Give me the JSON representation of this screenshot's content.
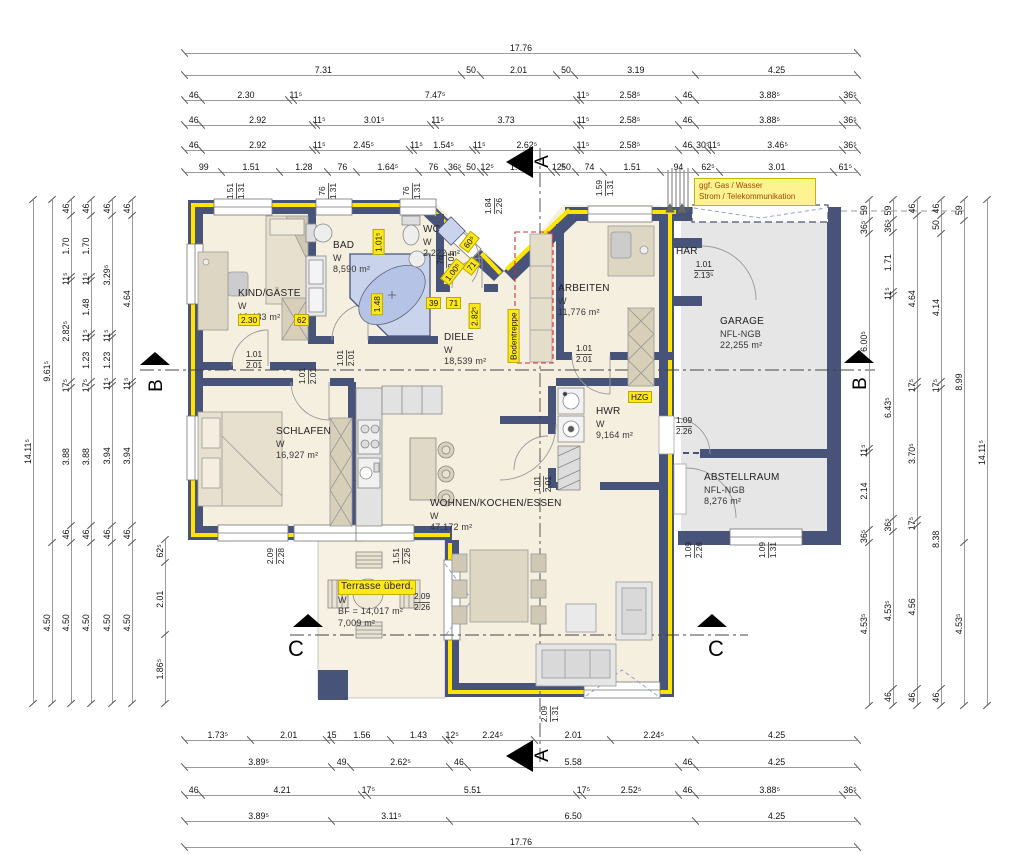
{
  "note": {
    "line1": "ggf. Gas / Wasser",
    "line2": "Strom / Telekommunikation"
  },
  "colors": {
    "wall": "#475379",
    "insulation_yellow": "#ffe400",
    "floor_cream": "#f5efe0",
    "garage_gray": "#e6e6e6",
    "highlight_yellow": "#ffe81a",
    "tub_blue": "#c9d4ec",
    "red_dashed": "#d03030",
    "dim_line_gray": "#9a9a9a"
  },
  "rooms": [
    {
      "id": "kind",
      "x": 238,
      "y": 288,
      "lines": [
        "KIND/GÄSTE",
        "W",
        "12,483 m²"
      ]
    },
    {
      "id": "bad",
      "x": 333,
      "y": 240,
      "lines": [
        "BAD",
        "W",
        "8,590 m²"
      ]
    },
    {
      "id": "wc",
      "x": 423,
      "y": 224,
      "lines": [
        "WC",
        "W",
        "2,222 m²"
      ]
    },
    {
      "id": "arbeiten",
      "x": 558,
      "y": 283,
      "lines": [
        "ARBEITEN",
        "W",
        "11,776 m²"
      ]
    },
    {
      "id": "garage",
      "x": 720,
      "y": 316,
      "lines": [
        "GARAGE",
        "NFL-NGB",
        "22,255 m²"
      ]
    },
    {
      "id": "har",
      "x": 676,
      "y": 246,
      "lines": [
        "HAR"
      ]
    },
    {
      "id": "diele",
      "x": 444,
      "y": 332,
      "lines": [
        "DIELE",
        "W",
        "18,539 m²"
      ]
    },
    {
      "id": "schlafen",
      "x": 276,
      "y": 426,
      "lines": [
        "SCHLAFEN",
        "W",
        "16,927 m²"
      ]
    },
    {
      "id": "wohnen",
      "x": 430,
      "y": 498,
      "lines": [
        "WOHNEN/KOCHEN/ESSEN",
        "W",
        "47,172 m²"
      ]
    },
    {
      "id": "hwr",
      "x": 596,
      "y": 406,
      "lines": [
        "HWR",
        "W",
        "9,164 m²"
      ]
    },
    {
      "id": "abstell",
      "x": 704,
      "y": 472,
      "lines": [
        "ABSTELLRAUM",
        "NFL-NGB",
        "8,276 m²"
      ]
    },
    {
      "id": "terrasse",
      "x": 338,
      "y": 580,
      "highlight_first": true,
      "lines": [
        "Terrasse überd.",
        "W",
        "BF = 14,017 m²",
        "7,009 m²"
      ]
    }
  ],
  "size_tags": [
    {
      "top": "1.01",
      "bot": "2.01",
      "x": 246,
      "y": 350,
      "vertical": false
    },
    {
      "top": "1.01",
      "bot": "2.01",
      "x": 338,
      "y": 348,
      "vertical": true
    },
    {
      "top": "1.01",
      "bot": "2.01",
      "x": 300,
      "y": 366,
      "vertical": true
    },
    {
      "top": "1.01",
      "bot": "2.01",
      "x": 535,
      "y": 474,
      "vertical": true
    },
    {
      "top": "1.01",
      "bot": "2.01",
      "x": 576,
      "y": 344,
      "vertical": false
    },
    {
      "top": "1.09",
      "bot": "2.26",
      "x": 676,
      "y": 416,
      "vertical": false
    },
    {
      "top": "1.01",
      "bot": "2.13⁵",
      "x": 694,
      "y": 260,
      "vertical": false
    },
    {
      "top": "1.09",
      "bot": "2.26",
      "x": 686,
      "y": 540,
      "vertical": true
    },
    {
      "top": "1.09",
      "bot": "1.31",
      "x": 760,
      "y": 540,
      "vertical": true
    },
    {
      "top": "2.09",
      "bot": "2.26",
      "x": 414,
      "y": 592,
      "vertical": false
    },
    {
      "top": "2.09",
      "bot": "2.28",
      "x": 268,
      "y": 546,
      "vertical": true
    },
    {
      "top": "1.51",
      "bot": "2.26",
      "x": 394,
      "y": 546,
      "vertical": true
    },
    {
      "top": "2.09",
      "bot": "1.31",
      "x": 542,
      "y": 704,
      "vertical": true
    },
    {
      "top": "1.84",
      "bot": "2.26",
      "x": 486,
      "y": 196,
      "vertical": true
    },
    {
      "top": "1.59",
      "bot": "1.31",
      "x": 597,
      "y": 178,
      "vertical": true
    },
    {
      "top": "3.01",
      "bot": "2.26",
      "x": 738,
      "y": 188,
      "vertical": true
    },
    {
      "top": "1.51",
      "bot": "1.31",
      "x": 228,
      "y": 181,
      "vertical": true
    },
    {
      "top": "76",
      "bot": "1.31",
      "x": 320,
      "y": 181,
      "vertical": true
    },
    {
      "top": "76",
      "bot": "1.31",
      "x": 404,
      "y": 181,
      "vertical": true
    },
    {
      "top": "76",
      "bot": "2.01",
      "x": 438,
      "y": 250,
      "vertical": true
    }
  ],
  "yellow_labels": [
    {
      "text": "2.30",
      "x": 238,
      "y": 314,
      "rot": 0
    },
    {
      "text": "62",
      "x": 294,
      "y": 314,
      "rot": 0
    },
    {
      "text": "1.01⁵",
      "x": 366,
      "y": 236,
      "rot": -90
    },
    {
      "text": "1.48",
      "x": 366,
      "y": 298,
      "rot": -90
    },
    {
      "text": "39",
      "x": 426,
      "y": 297,
      "rot": 0
    },
    {
      "text": "71",
      "x": 446,
      "y": 297,
      "rot": 0
    },
    {
      "text": "60⁵",
      "x": 460,
      "y": 236,
      "rot": -52
    },
    {
      "text": "71",
      "x": 464,
      "y": 260,
      "rot": -52
    },
    {
      "text": "1.00⁵",
      "x": 440,
      "y": 266,
      "rot": -52
    },
    {
      "text": "2.82⁵",
      "x": 462,
      "y": 310,
      "rot": -90
    },
    {
      "text": "Bodentreppe",
      "x": 487,
      "y": 330,
      "rot": -90
    },
    {
      "text": "HZG",
      "x": 628,
      "y": 391,
      "rot": 0
    }
  ],
  "section_markers": [
    {
      "letter": "A",
      "tri": "left",
      "tx": 506,
      "ty": 146,
      "lx": 536,
      "ly": 152,
      "rot": true,
      "big": false
    },
    {
      "letter": "A",
      "tri": "left",
      "tx": 506,
      "ty": 740,
      "lx": 536,
      "ly": 746,
      "rot": true,
      "big": false
    },
    {
      "letter": "B",
      "tri": "up",
      "tx": 140,
      "ty": 352,
      "lx": 150,
      "ly": 376,
      "rot": true,
      "big": false
    },
    {
      "letter": "B",
      "tri": "up",
      "tx": 844,
      "ty": 350,
      "lx": 854,
      "ly": 374,
      "rot": true,
      "big": false
    },
    {
      "letter": "C",
      "tri": "up",
      "tx": 293,
      "ty": 614,
      "lx": 288,
      "ly": 638,
      "rot": false,
      "big": true
    },
    {
      "letter": "C",
      "tri": "up",
      "tx": 697,
      "ty": 614,
      "lx": 708,
      "ly": 638,
      "rot": false,
      "big": true
    }
  ],
  "dims": {
    "top": [
      {
        "x": 185,
        "y": 40,
        "len": 672,
        "values": [
          "17.76"
        ]
      },
      {
        "x": 185,
        "y": 62,
        "len": 672,
        "values": [
          "7.31",
          "50",
          "2.01",
          "50",
          "3.19",
          "4.25"
        ]
      },
      {
        "x": 185,
        "y": 87,
        "len": 672,
        "values": [
          "46",
          "2.30",
          "11⁵",
          "7.47⁵",
          "11⁵",
          "2.58⁵",
          "46",
          "3.88⁵",
          "36⁵"
        ]
      },
      {
        "x": 185,
        "y": 112,
        "len": 672,
        "values": [
          "46",
          "2.92",
          "11⁵",
          "3.01⁵",
          "11⁵",
          "3.73",
          "11⁵",
          "2.58⁵",
          "46",
          "3.88⁵",
          "36⁵"
        ]
      },
      {
        "x": 185,
        "y": 137,
        "len": 672,
        "values": [
          "46",
          "2.92",
          "11⁵",
          "2.45⁵",
          "11⁵",
          "1.54⁵",
          "11⁵",
          "2.62⁵",
          "11⁵",
          "2.58⁵",
          "46",
          "30⁵",
          "11⁵",
          "3.46⁵",
          "36⁵"
        ]
      },
      {
        "x": 185,
        "y": 159,
        "len": 672,
        "values": [
          "99",
          "1.51",
          "1.28",
          "76",
          "1.64⁵",
          "76",
          "36⁵",
          "50",
          "12⁵",
          "1.76",
          "12⁵",
          "50",
          "74",
          "1.51",
          "94",
          "62⁵",
          "3.01",
          "61⁵"
        ]
      }
    ],
    "bottom": [
      {
        "x": 185,
        "y": 727,
        "len": 672,
        "values": [
          "1.73⁵",
          "2.01",
          "15",
          "1.56",
          "1.43",
          "12⁵",
          "2.24⁵",
          "2.01",
          "2.24⁵",
          "4.25"
        ]
      },
      {
        "x": 185,
        "y": 754,
        "len": 672,
        "values": [
          "3.89⁵",
          "49",
          "2.62⁵",
          "46",
          "5.58",
          "46",
          "4.25"
        ]
      },
      {
        "x": 185,
        "y": 782,
        "len": 672,
        "values": [
          "46",
          "4.21",
          "17⁵",
          "5.51",
          "17⁵",
          "2.52⁵",
          "46",
          "3.88⁵",
          "36⁵"
        ]
      },
      {
        "x": 185,
        "y": 808,
        "len": 672,
        "values": [
          "3.89⁵",
          "3.11⁵",
          "6.50",
          "4.25"
        ]
      },
      {
        "x": 185,
        "y": 834,
        "len": 672,
        "values": [
          "17.76"
        ]
      }
    ],
    "left": [
      {
        "x": 20,
        "y": 200,
        "len": 503,
        "values": [
          "14.11⁵"
        ]
      },
      {
        "x": 39,
        "y": 200,
        "len": 503,
        "values": [
          "9.61⁵",
          "4.50"
        ]
      },
      {
        "x": 58,
        "y": 200,
        "len": 503,
        "values": [
          "46",
          "1.70",
          "11⁵",
          "2.82⁵",
          "17⁵",
          "3.88",
          "46",
          "4.50"
        ]
      },
      {
        "x": 78,
        "y": 200,
        "len": 503,
        "values": [
          "46",
          "1.70",
          "11⁵",
          "1.48",
          "11⁵",
          "1.23",
          "17⁵",
          "3.88",
          "46",
          "4.50"
        ]
      },
      {
        "x": 99,
        "y": 200,
        "len": 503,
        "values": [
          "46",
          "3.29⁵",
          "11⁵",
          "1.23",
          "11⁵",
          "3.94",
          "46",
          "4.50"
        ]
      },
      {
        "x": 119,
        "y": 200,
        "len": 503,
        "values": [
          "46",
          "4.64",
          "11⁵",
          "3.94",
          "46",
          "4.50"
        ]
      },
      {
        "x": 152,
        "y": 540,
        "len": 163,
        "values": [
          "62⁵",
          "2.01",
          "1.86⁵"
        ]
      }
    ],
    "right": [
      {
        "x": 856,
        "y": 200,
        "len": 505,
        "values": [
          "59",
          "36⁵",
          "6.00⁵",
          "11⁵",
          "2.14",
          "36⁵",
          "4.53⁵"
        ]
      },
      {
        "x": 880,
        "y": 200,
        "len": 505,
        "values": [
          "59",
          "36⁵",
          "1.71",
          "11⁵",
          "6.43⁵",
          "36⁵",
          "4.53⁵",
          "46"
        ]
      },
      {
        "x": 904,
        "y": 200,
        "len": 505,
        "values": [
          "46",
          "4.64",
          "17⁵",
          "3.70⁵",
          "17⁵",
          "4.56",
          "46"
        ]
      },
      {
        "x": 928,
        "y": 200,
        "len": 505,
        "values": [
          "46",
          "50",
          "4.14",
          "17⁵",
          "8.38",
          "46"
        ]
      },
      {
        "x": 951,
        "y": 200,
        "len": 505,
        "values": [
          "59",
          "8.99",
          "4.53⁵"
        ]
      },
      {
        "x": 974,
        "y": 200,
        "len": 505,
        "values": [
          "14.11⁵"
        ]
      }
    ]
  }
}
